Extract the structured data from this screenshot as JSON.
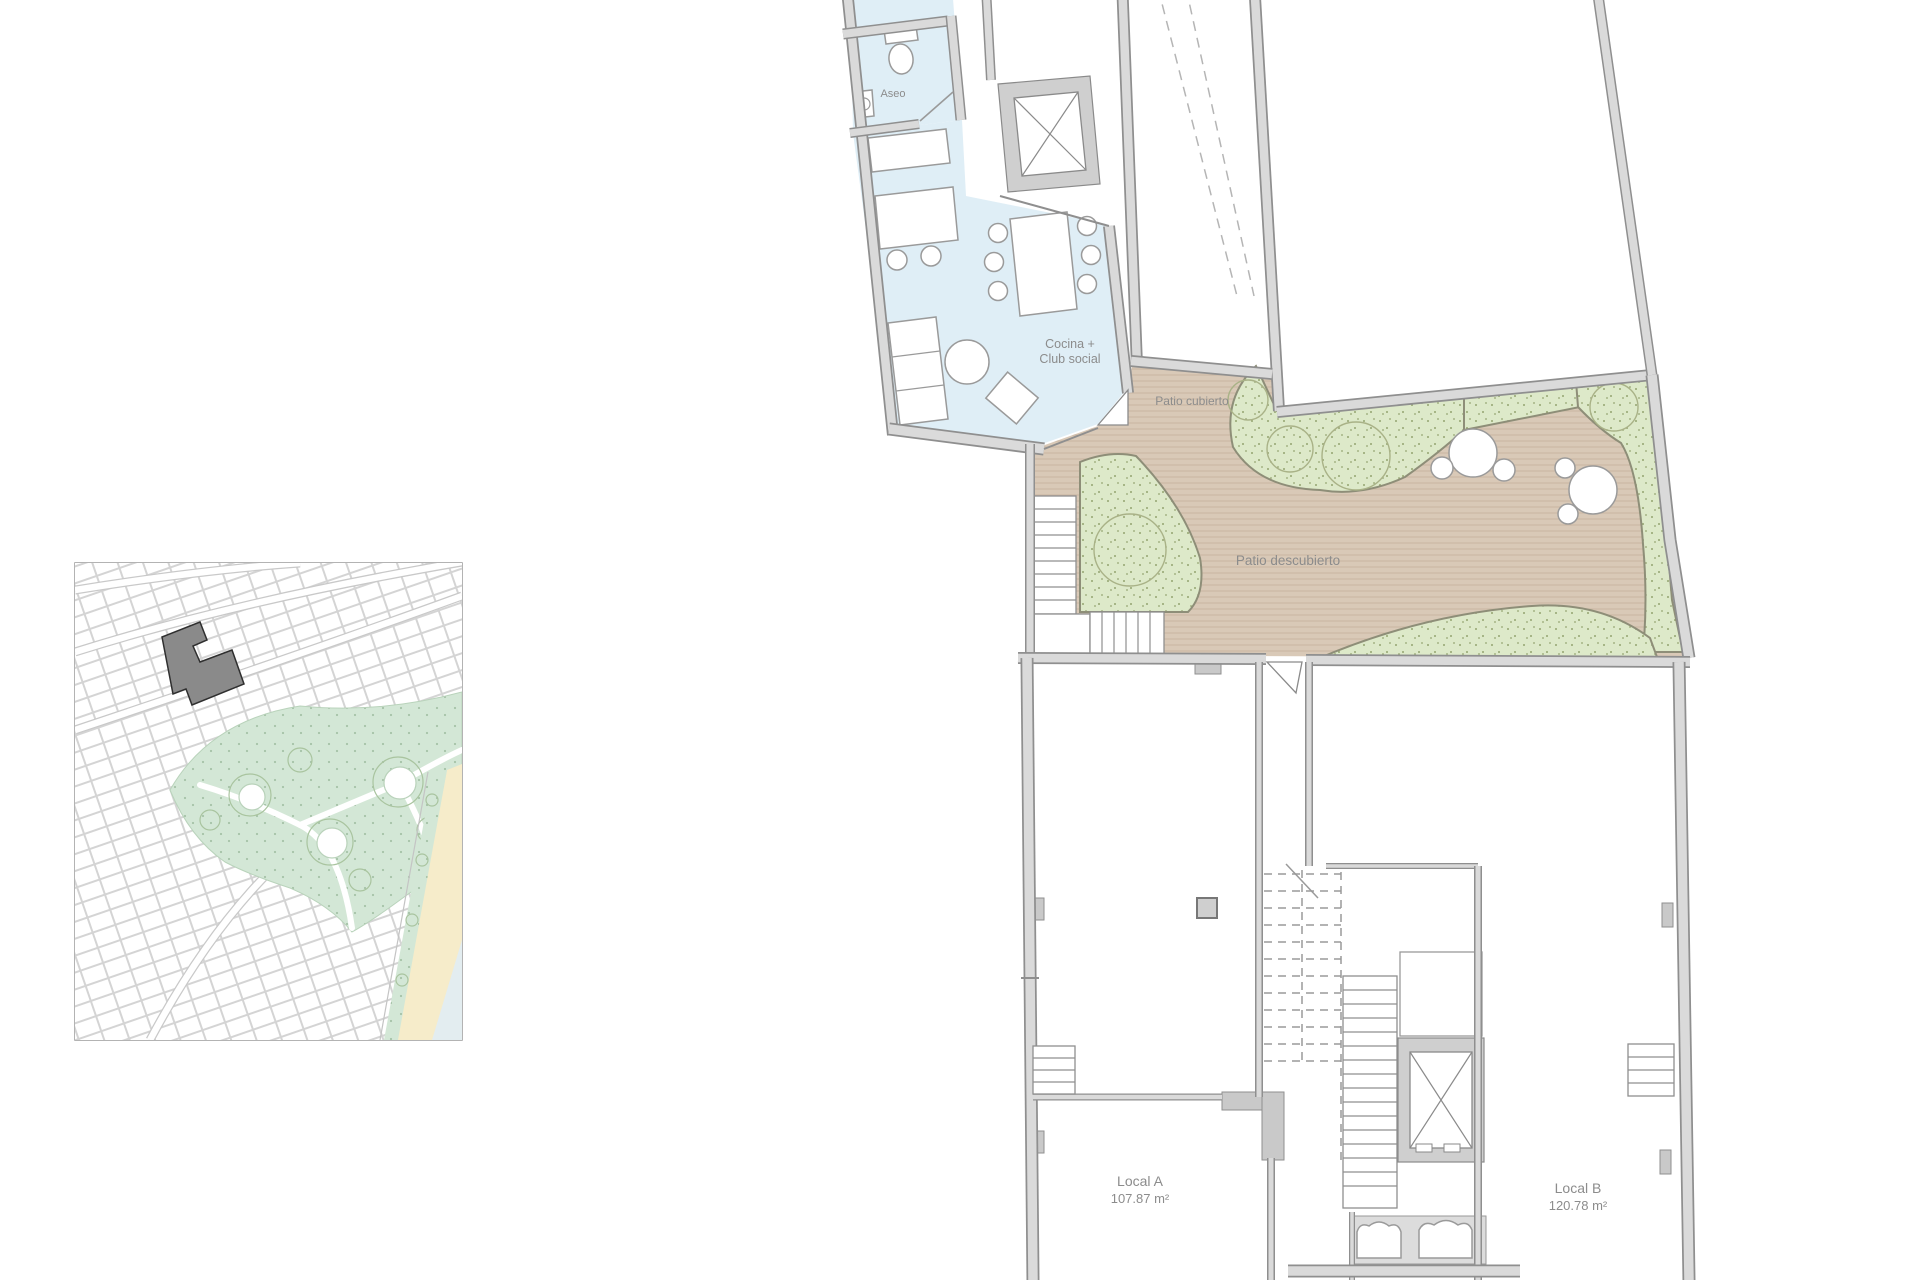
{
  "plan": {
    "rooms": {
      "aseo": {
        "label": "Aseo"
      },
      "club": {
        "line1": "Cocina +",
        "line2": "Club social"
      },
      "patio_cubierto": {
        "label": "Patio cubierto"
      },
      "patio_descubierto": {
        "label": "Patio descubierto"
      },
      "local_a": {
        "name": "Local A",
        "area": "107.87 m²"
      },
      "local_b": {
        "name": "Local B",
        "area": "120.78 m²"
      }
    },
    "colors": {
      "room_fill": "#dfeef6",
      "deck": "#d9c9b7",
      "deck_stripe": "#cbb7a2",
      "green": "#dde9c9",
      "wall_fill": "#dadada",
      "wall_edge": "#8f8f8f",
      "label_text": "#8c8c8c"
    }
  },
  "site_map": {
    "colors": {
      "park": "#d3e7d6",
      "sand": "#f6ecca",
      "sea": "#e3edf0",
      "highlighted_building": "#8a8a8a",
      "parcel_line": "#d4d4d4"
    }
  }
}
